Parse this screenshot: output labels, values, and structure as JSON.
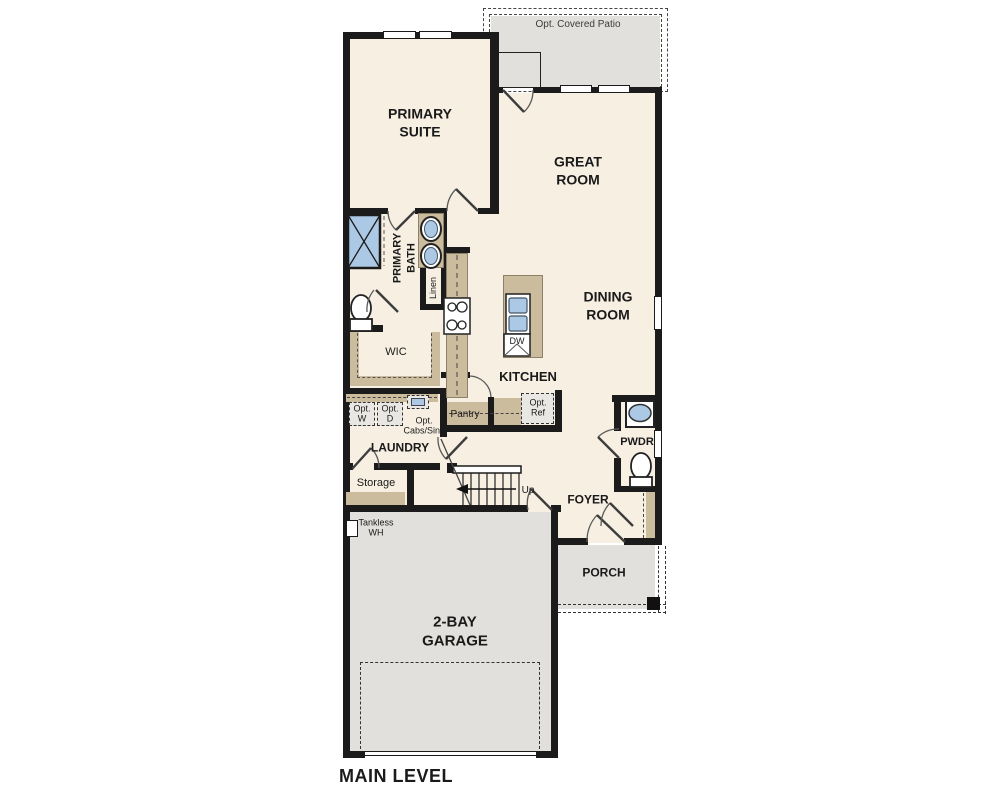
{
  "plan": {
    "title": "MAIN LEVEL",
    "rooms": {
      "patio": "Opt. Covered Patio",
      "primary_suite": "PRIMARY\nSUITE",
      "great_room": "GREAT\nROOM",
      "primary_bath": "PRIMARY\nBATH",
      "linen": "Linen",
      "dining_room": "DINING\nROOM",
      "wic": "WIC",
      "kitchen": "KITCHEN",
      "dw": "DW",
      "pantry": "Pantry",
      "opt_ref": "Opt.\nRef",
      "opt_w": "Opt.\nW",
      "opt_d": "Opt.\nD",
      "opt_cabs_sink": "Opt.\nCabs/Sink",
      "laundry": "LAUNDRY",
      "storage": "Storage",
      "up": "Up",
      "pwdr": "PWDR",
      "foyer": "FOYER",
      "tankless_wh": "Tankless\nWH",
      "porch": "PORCH",
      "garage": "2-BAY\nGARAGE"
    },
    "colors": {
      "wall": "#1b1b1b",
      "floor": "#f7efe2",
      "exterior_concrete": "#e1e0dd",
      "cabinetry_tan": "#cbbc9e",
      "fixture_blue": "#abc8e5",
      "optional_item_fill": "#e8e7e4"
    }
  }
}
